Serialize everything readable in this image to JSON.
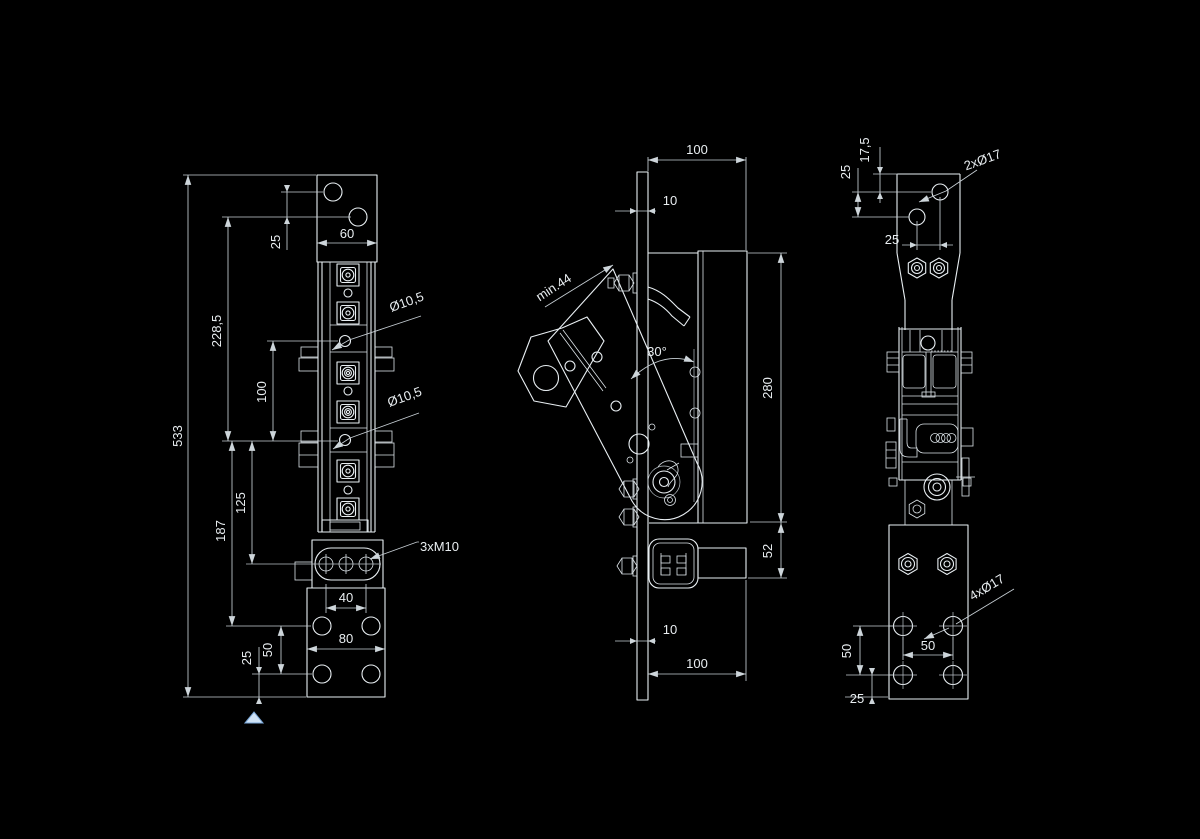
{
  "drawing": {
    "background": "#000000",
    "line_color": "#e9eff3",
    "dim_color": "#c7cfd5",
    "cursor_color": "#cfe2f5",
    "front_view": {
      "dim_overall_height": "533",
      "dim_upper_offset": "228,5",
      "dim_pivot_spacing": "100",
      "dim_mid_spacing": "125",
      "dim_lower_spacing": "187",
      "dim_top_hole_pitch": "25",
      "dim_width": "60",
      "label_hole_upper": "Ø10,5",
      "label_hole_lower": "Ø10,5",
      "label_thread": "3xM10",
      "dim_slot_pitch": "40",
      "dim_base_width": "80",
      "dim_base_hole_pitch": "50",
      "dim_base_edge": "25"
    },
    "side_view": {
      "dim_top_width": "100",
      "dim_plate_thickness_top": "10",
      "dim_min_length": "min.44",
      "dim_angle": "30°",
      "dim_body_height": "280",
      "dim_step_height": "52",
      "dim_plate_thickness_bottom": "10",
      "dim_bottom_width": "100"
    },
    "rear_view": {
      "dim_flange_top_edge": "17,5",
      "dim_top_pitch_vertical": "25",
      "dim_top_pitch_horizontal": "25",
      "label_holes_top": "2xØ17",
      "dim_base_pitch_vertical": "50",
      "dim_base_pitch_horizontal": "50",
      "dim_base_edge": "25",
      "label_holes_bottom": "4xØ17"
    }
  }
}
